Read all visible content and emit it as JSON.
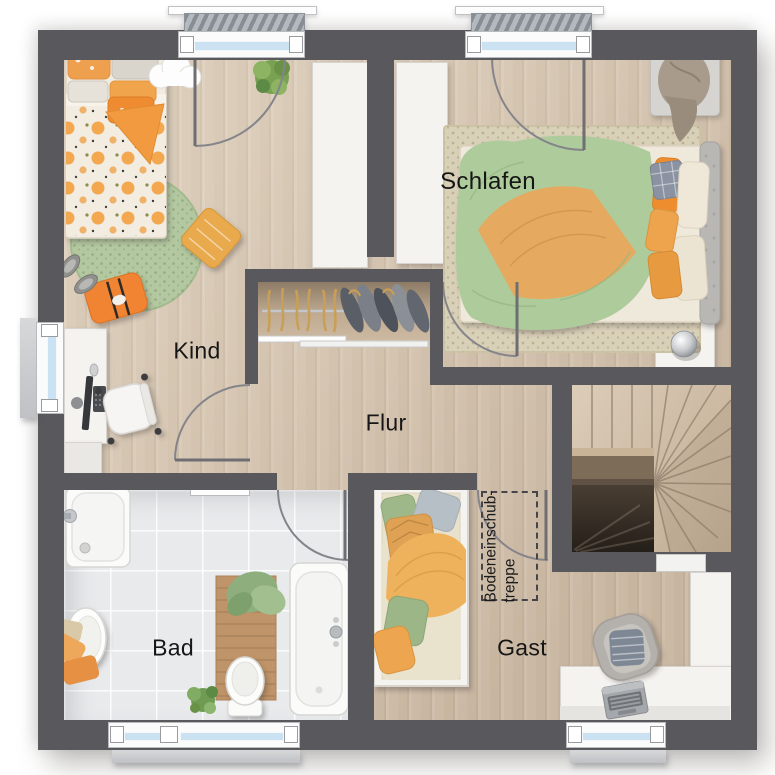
{
  "title": "floor-plan-upper-floor",
  "rooms": {
    "kind": {
      "label": "Kind",
      "items": [
        "single-bed",
        "round-rug",
        "decor-pillow",
        "floor-cushion",
        "slippers",
        "desk",
        "office-chair",
        "monitor",
        "keyboard",
        "plant",
        "cloud-shelf",
        "wardrobe"
      ]
    },
    "schlafen": {
      "label": "Schlafen",
      "items": [
        "double-bed",
        "area-rug",
        "headboard",
        "bench",
        "blanket",
        "nightstand",
        "table-lamp",
        "wardrobe"
      ]
    },
    "flur": {
      "label": "Flur",
      "items": [
        "open-closet",
        "clothes-rail",
        "hangers",
        "garments"
      ]
    },
    "bad": {
      "label": "Bad",
      "items": [
        "shower",
        "washbasin",
        "bathtub",
        "toilet",
        "wooden-bath-mat",
        "green-towel",
        "orange-towels",
        "plant",
        "towel-radiator"
      ]
    },
    "gast": {
      "label": "Gast",
      "items": [
        "single-bed",
        "armchair",
        "cushion",
        "desk",
        "laptop",
        "wardrobe"
      ]
    }
  },
  "annotations": {
    "attic_ladder": {
      "line1": "Bodeneinschub-",
      "line2": "treppe"
    }
  },
  "stairs": {
    "type": "winder-staircase"
  },
  "colors": {
    "wall": "#58585d",
    "wood_floor": "#d4c3af",
    "tile_floor": "#e8eaec",
    "window_glass": "#cbe2f3",
    "accent_orange": "#f08431",
    "accent_soft_orange": "#e8a34e",
    "accent_green": "#aecb9b",
    "rug_green": "#b3c8a0",
    "rug_beige": "#d9d0b8",
    "door_arc": "#85858a",
    "label_text": "#161616"
  }
}
